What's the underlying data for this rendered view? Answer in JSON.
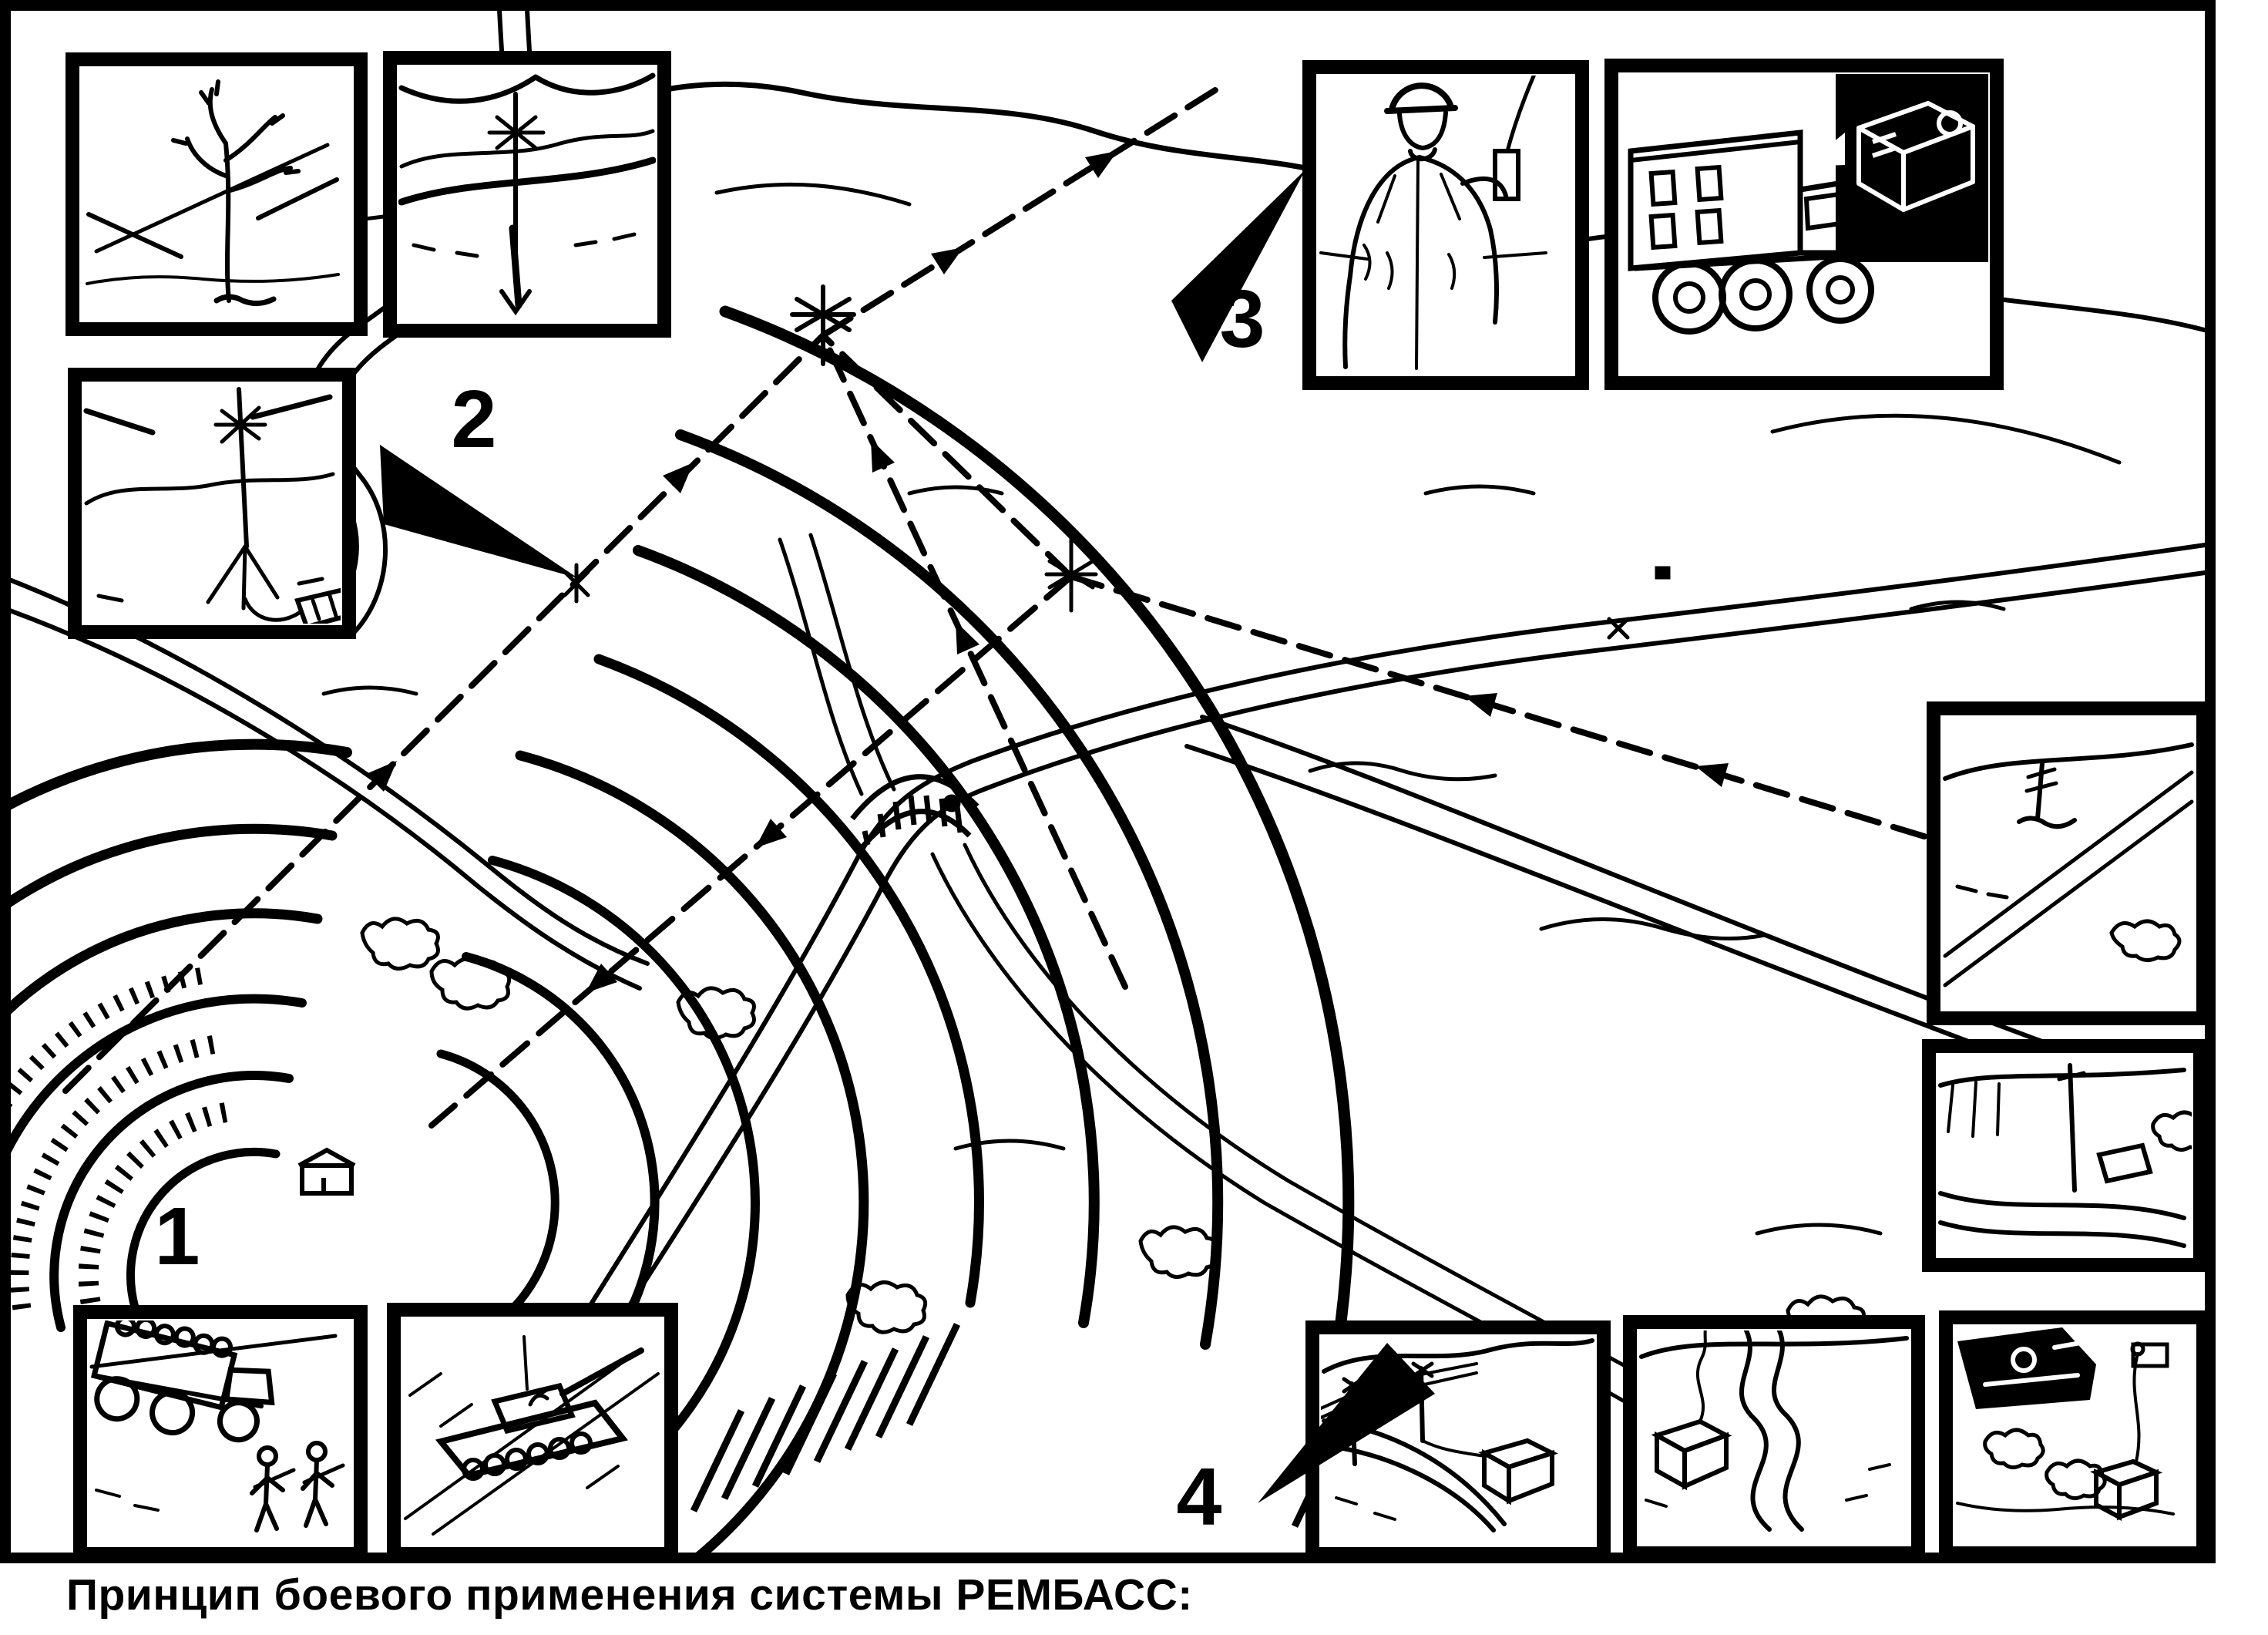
{
  "figure": {
    "caption": "Принцип боевого применения системы РЕМБАСС:",
    "colors": {
      "ink": "#000000",
      "paper": "#ffffff"
    },
    "callouts": [
      {
        "label": "1"
      },
      {
        "label": "2"
      },
      {
        "label": "3"
      },
      {
        "label": "4"
      }
    ],
    "panels": [
      {
        "icon": "sensor-on-tree-icon"
      },
      {
        "icon": "buried-seismic-sensor-icon"
      },
      {
        "icon": "relay-antenna-transmitter-icon"
      },
      {
        "icon": "operator-with-handset-icon"
      },
      {
        "icon": "control-truck-monitor-icon"
      },
      {
        "icon": "field-antenna-sensor-icon"
      },
      {
        "icon": "roadside-sensor-icon"
      },
      {
        "icon": "troop-truck-icon"
      },
      {
        "icon": "tank-icon"
      },
      {
        "icon": "wire-antenna-relay-icon"
      },
      {
        "icon": "repeater-box-icon"
      },
      {
        "icon": "tank-with-sensor-box-icon"
      }
    ]
  }
}
